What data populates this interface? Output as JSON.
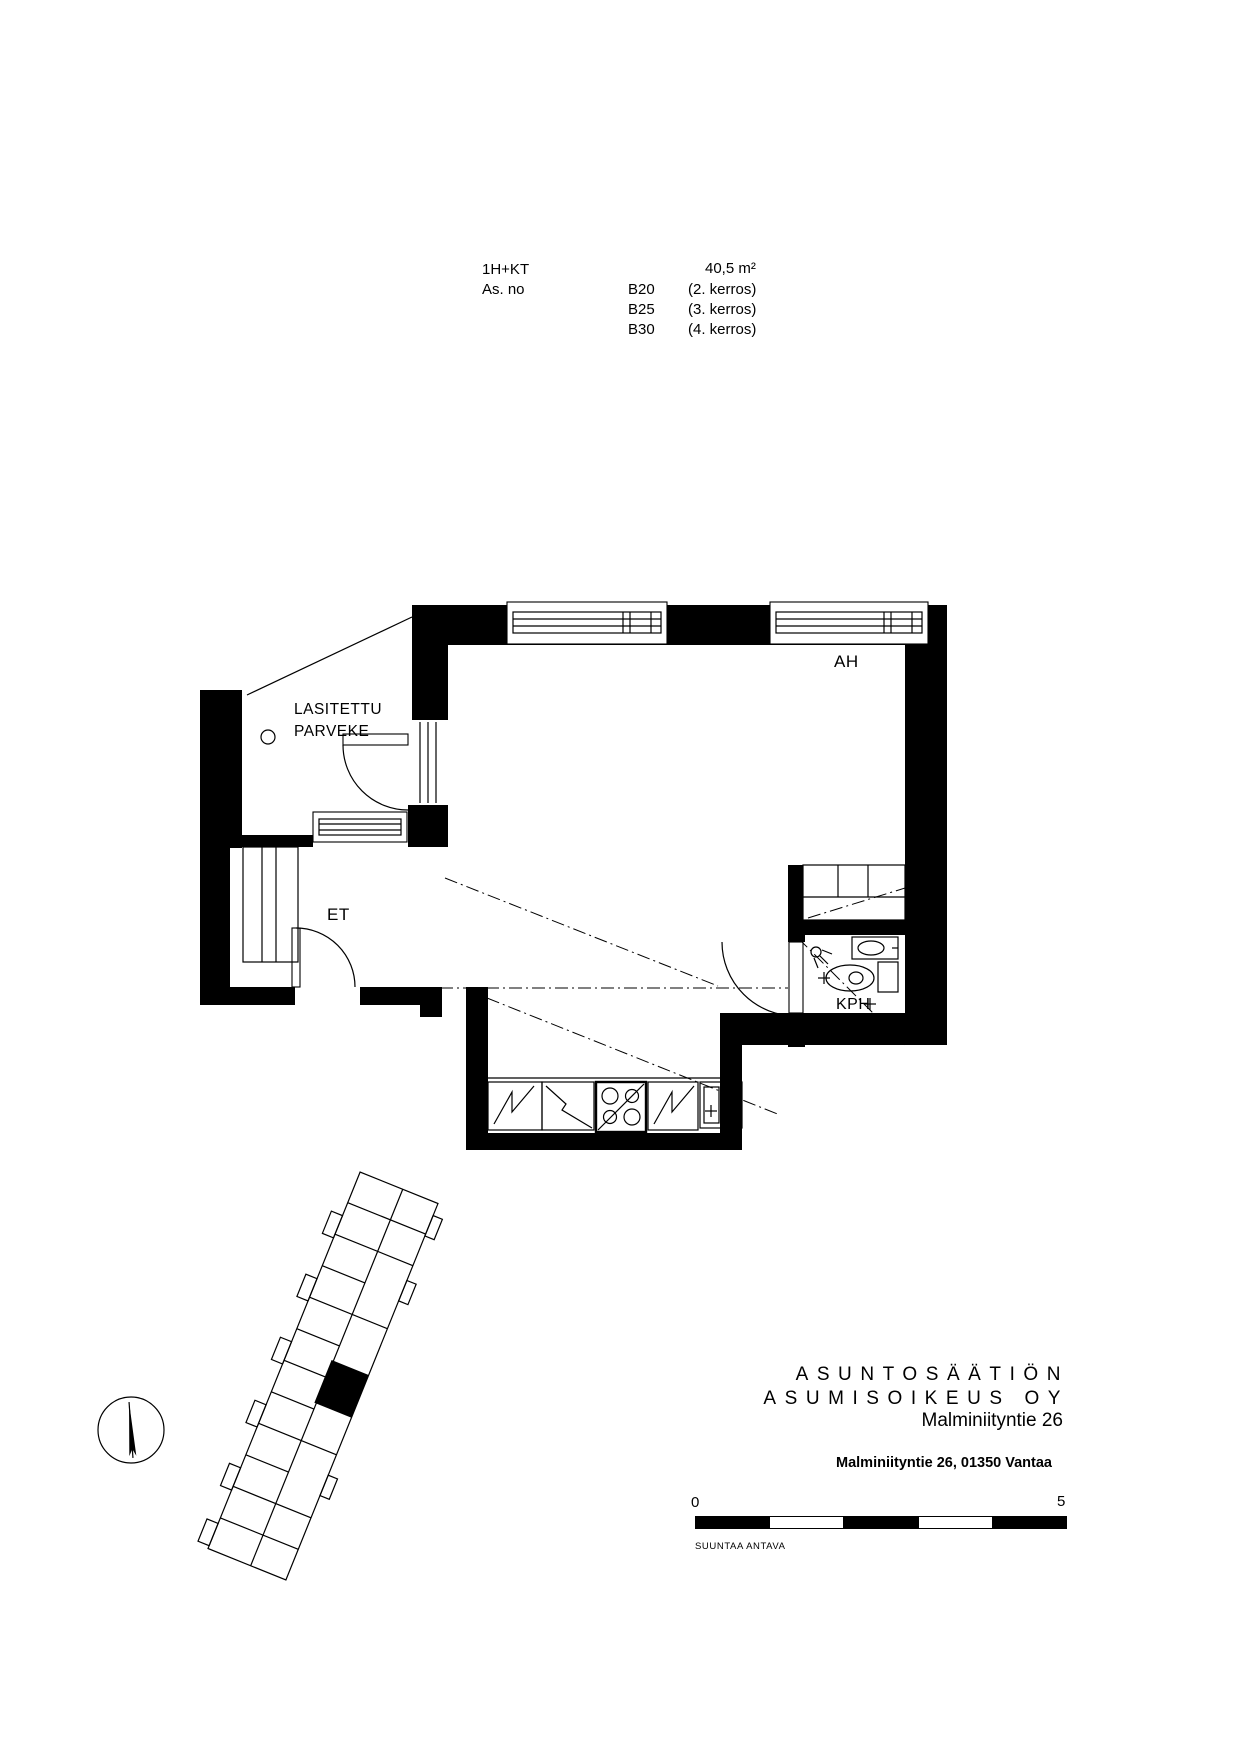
{
  "header": {
    "apartment_type": "1H+KT",
    "as_no_label": "As. no",
    "area": "40,5 m²",
    "units": [
      {
        "id": "B20",
        "floor": "(2. kerros)"
      },
      {
        "id": "B25",
        "floor": "(3. kerros)"
      },
      {
        "id": "B30",
        "floor": "(4. kerros)"
      }
    ]
  },
  "plan": {
    "room_ah": "AH",
    "balcony_line1": "LASITETTU",
    "balcony_line2": "PARVEKE",
    "room_et": "ET",
    "room_kph": "KPH"
  },
  "footer": {
    "company_line1": "ASUNTOSÄÄTIÖN",
    "company_line2": "ASUMISOIKEUS OY",
    "company_line3": "Malminiityntie 26",
    "address": "Malminiityntie 26, 01350 Vantaa",
    "scale_start": "0",
    "scale_end": "5",
    "scale_note": "SUUNTAA ANTAVA"
  },
  "colors": {
    "ink": "#000000",
    "paper": "#ffffff"
  }
}
